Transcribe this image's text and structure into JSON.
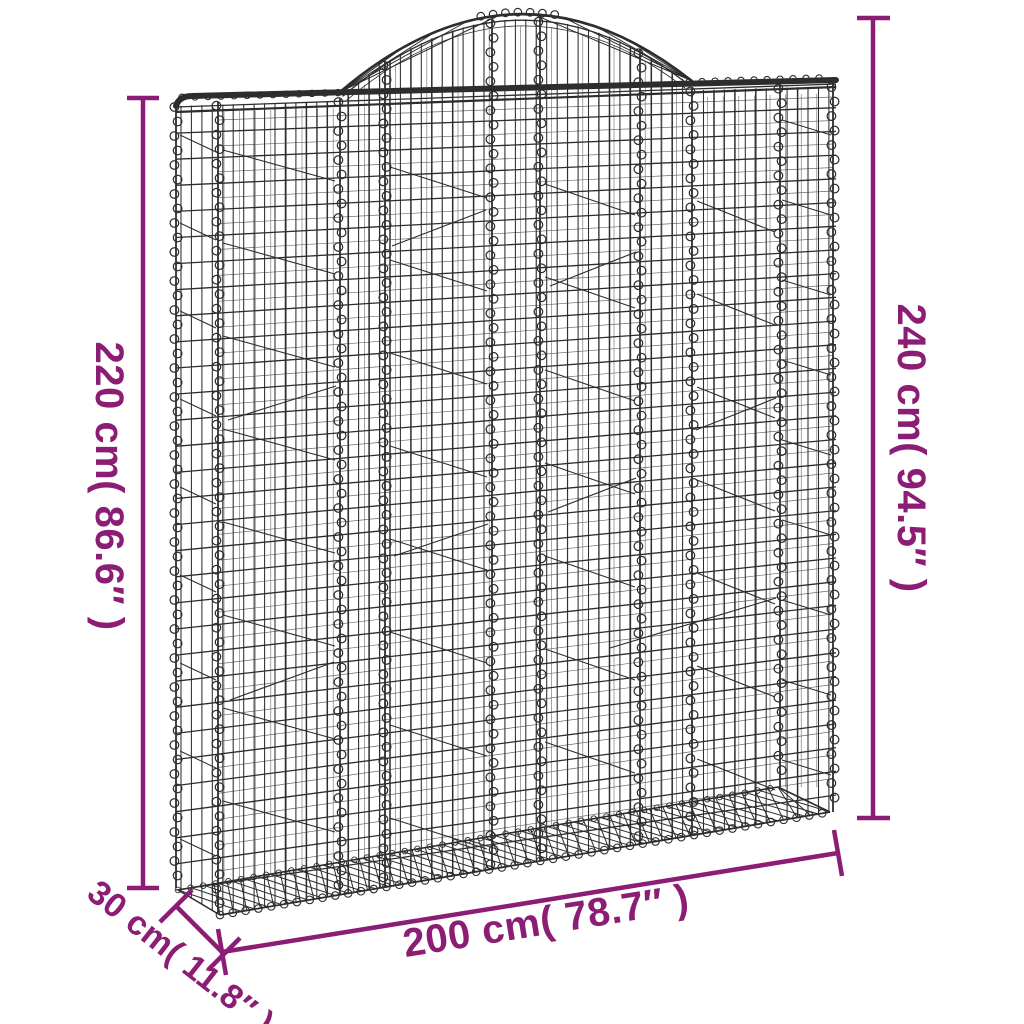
{
  "diagram": {
    "type": "product-dimension-diagram",
    "product": "arched gabion mesh basket",
    "labels": {
      "height_front": "220 cm( 86.6″ )",
      "height_total": "240 cm( 94.5″ )",
      "width": "200 cm( 78.7″ )",
      "depth": "30 cm( 11.8″ )"
    }
  },
  "colors": {
    "dimension": "#8C1D74",
    "wire": "#2D2D2D",
    "wire_light": "#6A6A6A",
    "background": "#FFFFFF"
  }
}
